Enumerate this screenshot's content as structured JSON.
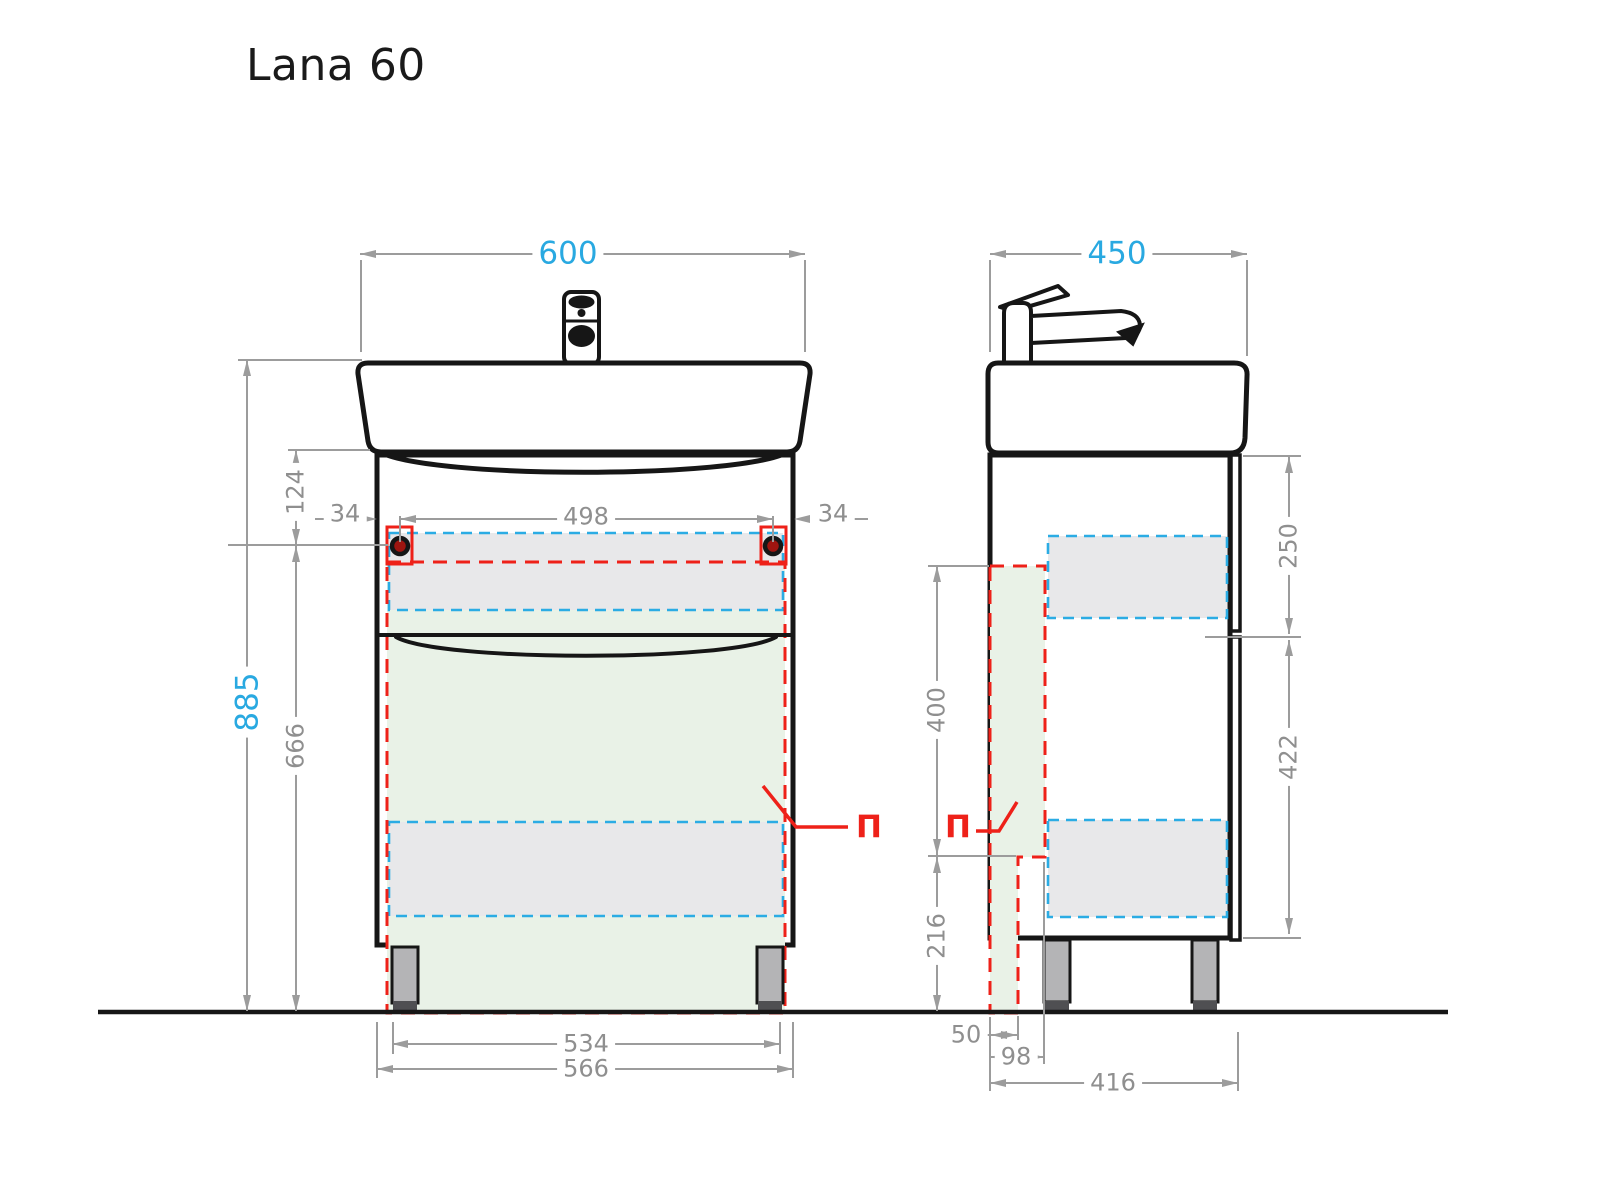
{
  "title": "Lana 60",
  "colors": {
    "outline_black": "#161616",
    "dimension_gray": "#9c9c9c",
    "accent_blue": "#29a9e1",
    "accent_red": "#ee2119",
    "zone_green_fill": "#e9f2e7",
    "drawer_gray_fill": "#e8e8ea",
    "leg_gray": "#b4b4b6"
  },
  "front": {
    "width": "600",
    "height_total": "885",
    "upper_offset": "124",
    "lower_height": "666",
    "handle_inset_left": "34",
    "handle_span": "498",
    "handle_inset_right": "34",
    "leg_span": "534",
    "body_width": "566",
    "section": "П"
  },
  "side": {
    "depth": "450",
    "top_drawer": "250",
    "bottom_drawer": "422",
    "inner_front": "400",
    "lower_zone": "216",
    "plinth_inset": "50",
    "plinth_depth": "98",
    "leg_depth": "416",
    "section": "П"
  }
}
